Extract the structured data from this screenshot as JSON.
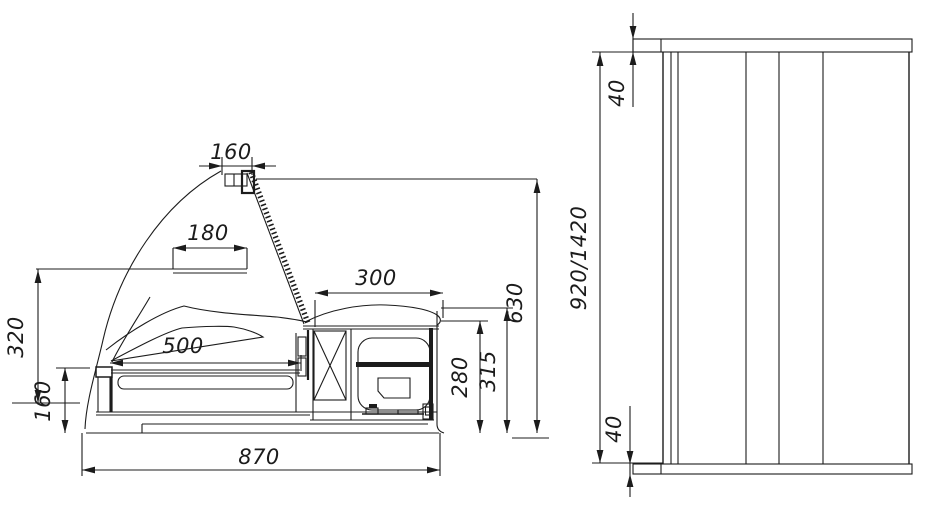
{
  "drawing": {
    "background_color": "#ffffff",
    "line_color": "#1c1c1c",
    "dimensions": {
      "lamp_width": "160",
      "shelf_width": "180",
      "shelf_height": "320",
      "front_height": "160",
      "deck_length": "500",
      "machine_width": "300",
      "machine_height": "280",
      "counter_height": "315",
      "canopy_height": "630",
      "depth_total": "870",
      "panel_top_thickness": "40",
      "panel_height": "920/1420",
      "panel_bottom_thickness": "40"
    }
  }
}
